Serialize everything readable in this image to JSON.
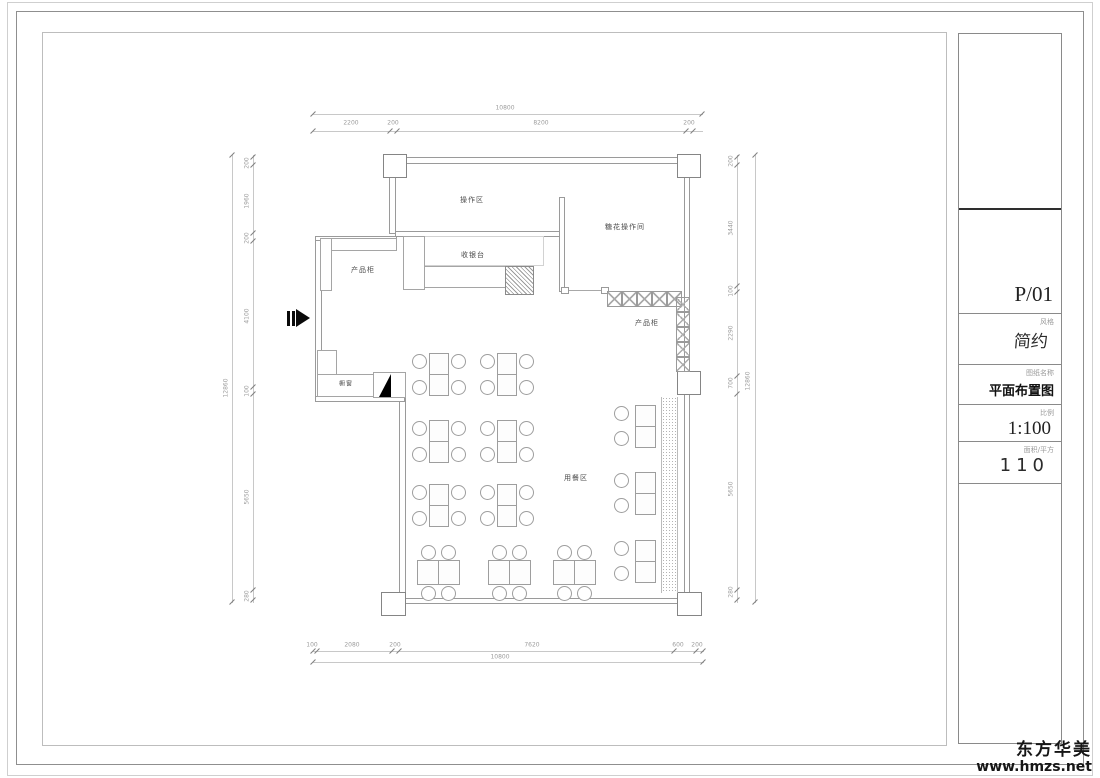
{
  "drawing": {
    "labels": {
      "operation_area": "操作区",
      "sugar_flower_room": "糖花操作间",
      "cashier_counter": "收银台",
      "product_cabinet_left": "产品柜",
      "product_cabinet_right": "产品柜",
      "display_window": "橱窗",
      "dining_area": "用餐区"
    },
    "dimensions": {
      "top": {
        "overall": "10800",
        "segments": [
          "2200",
          "200",
          "8200",
          "200"
        ]
      },
      "bottom": {
        "overall": "10800",
        "segments": [
          "100",
          "2080",
          "200",
          "7620",
          "600",
          "200"
        ]
      },
      "left": {
        "overall": "12860",
        "segments": [
          "200",
          "1960",
          "200",
          "4100",
          "100",
          "5650",
          "280"
        ]
      },
      "right": {
        "overall": "12860",
        "segments": [
          "200",
          "3440",
          "100",
          "2290",
          "700",
          "5650",
          "280"
        ]
      }
    }
  },
  "title_block": {
    "page_number": "P/01",
    "style_label": "风格",
    "style_value": "简约",
    "drawing_name_label": "图纸名称",
    "drawing_name_value": "平面布置图",
    "scale_label": "比例",
    "scale_value": "1:100",
    "area_label": "面积/平方",
    "area_value": "110"
  },
  "watermark": {
    "brand": "东方华美",
    "website": "www.hmzs.net"
  }
}
